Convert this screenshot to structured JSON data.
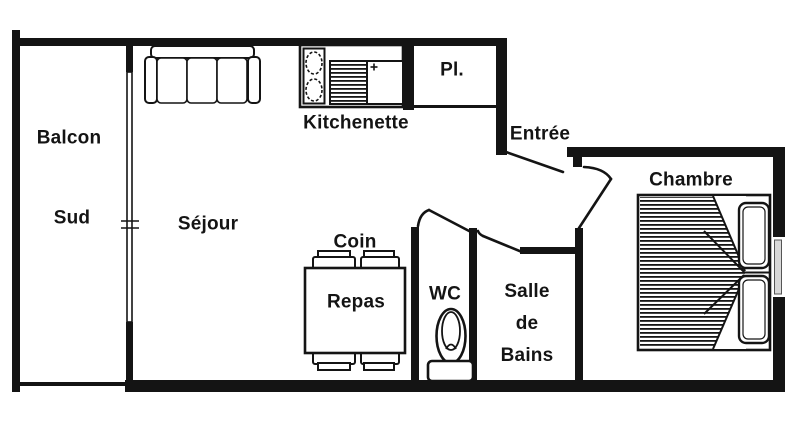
{
  "colors": {
    "wall": "#141414",
    "background": "#ffffff",
    "window_pane": "#d9d9d9"
  },
  "rooms": {
    "balcon": {
      "label_line1": "Balcon",
      "label_line2": "Sud"
    },
    "sejour": {
      "label": "Séjour"
    },
    "kitchenette": {
      "label": "Kitchenette"
    },
    "placard": {
      "label": "Pl."
    },
    "entree": {
      "label": "Entrée"
    },
    "chambre": {
      "label": "Chambre"
    },
    "coin_repas": {
      "label_line1": "Coin",
      "label_line2": "Repas"
    },
    "wc": {
      "label": "WC"
    },
    "salle_de_bains": {
      "label_line1": "Salle",
      "label_line2": "de",
      "label_line3": "Bains"
    }
  },
  "furniture": {
    "sofa": "three-seat-sofa",
    "stove": "two-burner-hob",
    "sink": "sink-with-drainboard",
    "cabinet": "kitchen-cabinet",
    "dining_table": "square-table-four-chairs",
    "toilet": "toilet-with-tank",
    "bed": "double-bed-striped-blanket",
    "pillows": "two-pillows",
    "balcony_window": "window-double-line",
    "bedroom_window": "window-in-wall"
  }
}
